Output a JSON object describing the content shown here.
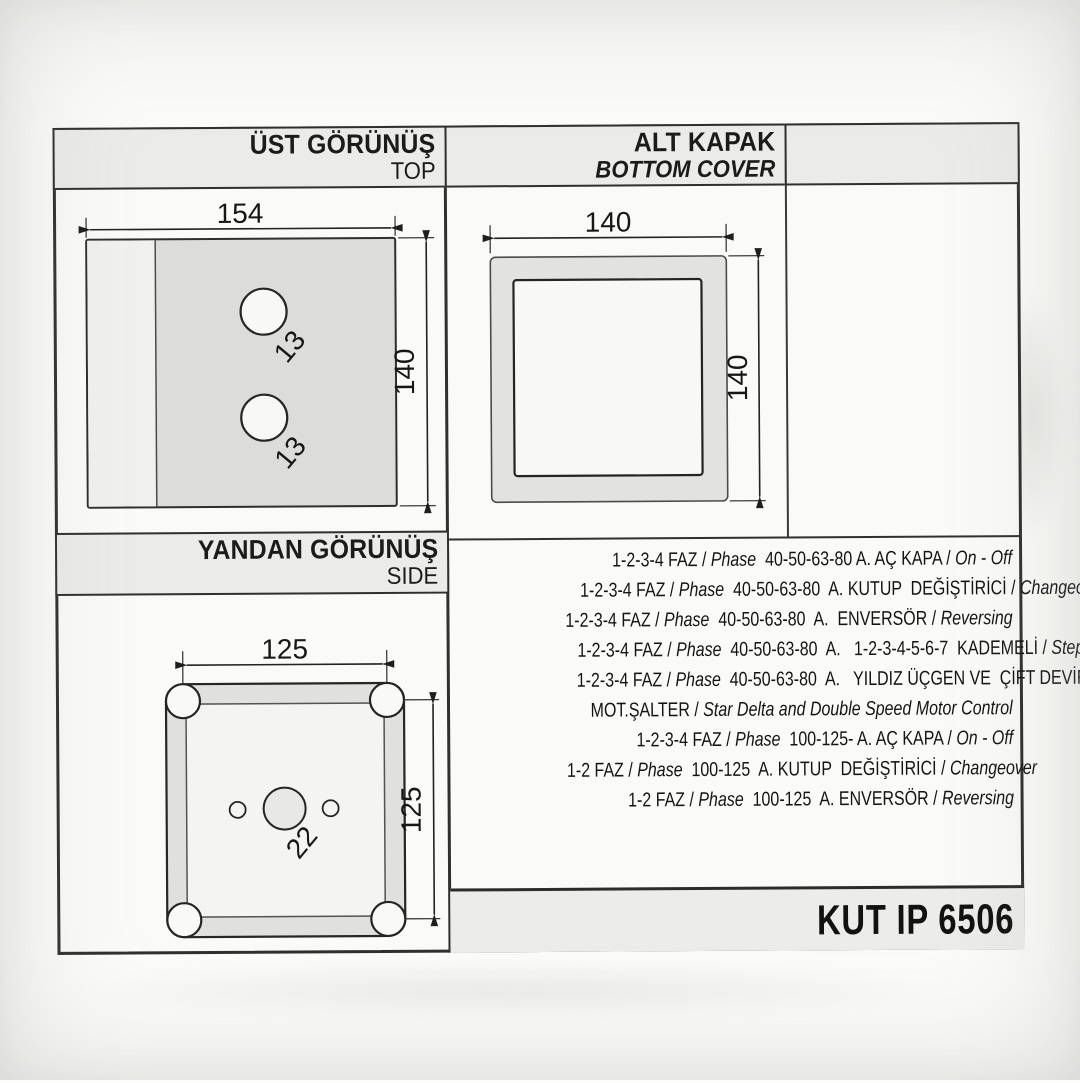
{
  "colors": {
    "paper": "#fafaf8",
    "header_bar": "#ebebe9",
    "frame_line": "#30302e",
    "plate_gray": "#dcdcda",
    "cover_gray": "#e2e2e0"
  },
  "panels": {
    "top_view": {
      "title_tr": "ÜST GÖRÜNÜŞ",
      "title_en": "TOP",
      "dim_width": "154",
      "dim_height": "140",
      "hole_upper": "13",
      "hole_lower": "13"
    },
    "bottom_cover": {
      "title_tr": "ALT KAPAK",
      "title_en": "BOTTOM COVER",
      "dim_width": "140",
      "dim_height": "140"
    },
    "side_view": {
      "title_tr": "YANDAN GÖRÜNÜŞ",
      "title_en": "SIDE",
      "dim_width": "125",
      "dim_height": "125",
      "hole_center": "22"
    }
  },
  "spec_lines": [
    {
      "segments": [
        {
          "text": "1-2-3-4 FAZ / "
        },
        {
          "text": "Phase",
          "italic": true
        },
        {
          "text": "  40-50-63-80 A. AÇ KAPA / "
        },
        {
          "text": "On - Off",
          "italic": true
        }
      ]
    },
    {
      "segments": [
        {
          "text": "1-2-3-4 FAZ / "
        },
        {
          "text": "Phase",
          "italic": true
        },
        {
          "text": "  40-50-63-80  A. KUTUP  DEĞİŞTİRİCİ / "
        },
        {
          "text": "Changeover",
          "italic": true
        }
      ]
    },
    {
      "segments": [
        {
          "text": "1-2-3-4 FAZ / "
        },
        {
          "text": "Phase",
          "italic": true
        },
        {
          "text": "  40-50-63-80  A.  ENVERSÖR / "
        },
        {
          "text": "Reversing",
          "italic": true
        }
      ]
    },
    {
      "segments": [
        {
          "text": "1-2-3-4 FAZ / "
        },
        {
          "text": "Phase",
          "italic": true
        },
        {
          "text": "  40-50-63-80  A.   1-2-3-4-5-6-7  KADEMELİ / "
        },
        {
          "text": "Steps",
          "italic": true
        }
      ]
    },
    {
      "segments": [
        {
          "text": "1-2-3-4 FAZ / "
        },
        {
          "text": "Phase",
          "italic": true
        },
        {
          "text": "  40-50-63-80  A.   YILDIZ ÜÇGEN VE  ÇİFT DEVİR"
        }
      ]
    },
    {
      "segments": [
        {
          "text": "MOT.ŞALTER / "
        },
        {
          "text": "Star Delta and Double Speed Motor Control",
          "italic": true
        }
      ]
    },
    {
      "segments": [
        {
          "text": "1-2-3-4 FAZ / "
        },
        {
          "text": "Phase",
          "italic": true
        },
        {
          "text": "  100-125- A. AÇ KAPA / "
        },
        {
          "text": "On - Off",
          "italic": true
        }
      ]
    },
    {
      "segments": [
        {
          "text": "1-2 FAZ / "
        },
        {
          "text": "Phase",
          "italic": true
        },
        {
          "text": "  100-125  A. KUTUP  DEĞİŞTİRİCİ / "
        },
        {
          "text": "Changeover",
          "italic": true
        }
      ]
    },
    {
      "segments": [
        {
          "text": "1-2 FAZ / "
        },
        {
          "text": "Phase",
          "italic": true
        },
        {
          "text": "  100-125  A. ENVERSÖR / "
        },
        {
          "text": "Reversing",
          "italic": true
        }
      ]
    }
  ],
  "model_code": "KUT IP 6506"
}
